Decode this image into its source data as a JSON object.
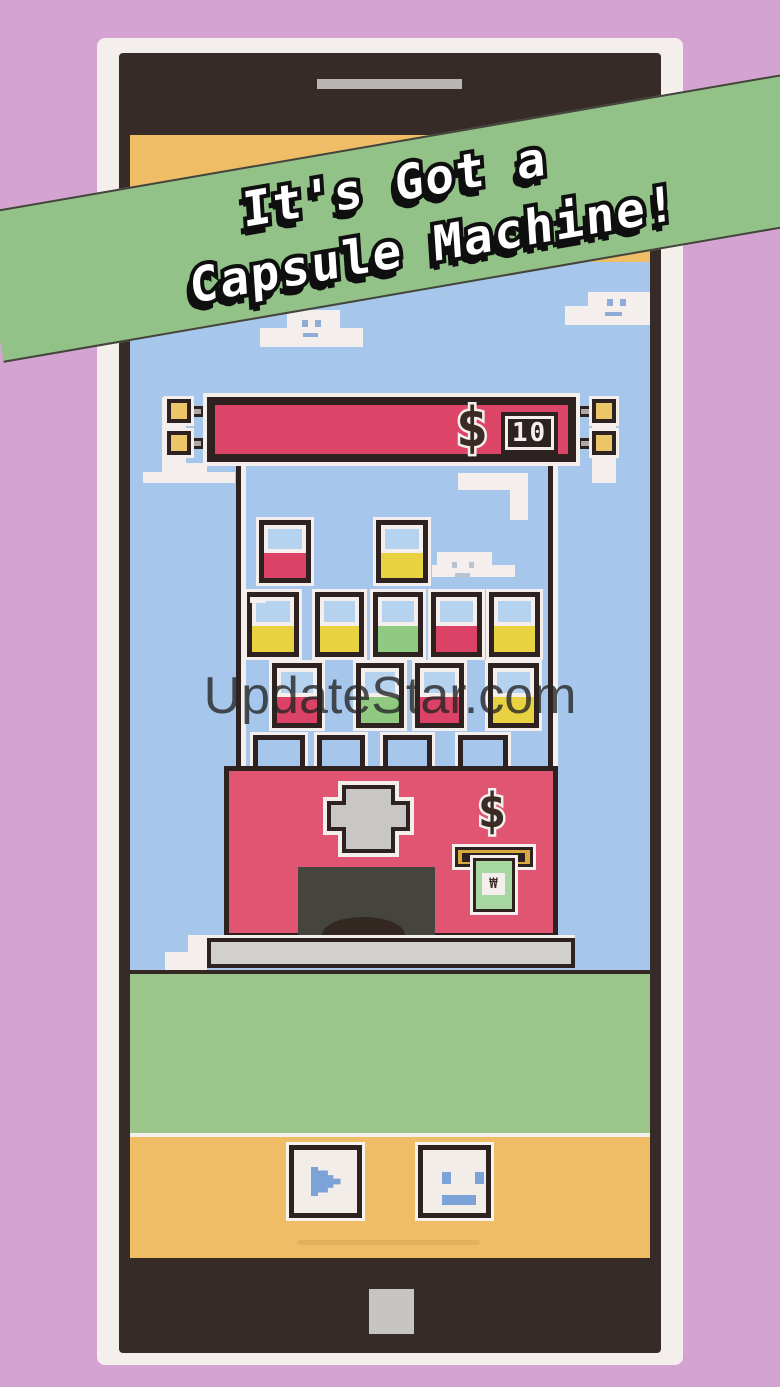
{
  "banner": {
    "line1": "It's Got a",
    "line2": "Capsule Machine!"
  },
  "watermark": {
    "text": "UpdateStar.com"
  },
  "price_sign": {
    "currency_symbol": "$",
    "value": "10"
  },
  "machine": {
    "currency_symbol": "$",
    "bill_symbol": "₩"
  },
  "capsules": {
    "rows": [
      {
        "name": "top",
        "colors": [
          "red",
          "yellow"
        ]
      },
      {
        "name": "middle",
        "colors": [
          "yellow",
          "yellow",
          "green",
          "red",
          "yellow"
        ]
      },
      {
        "name": "lower",
        "colors": [
          "red",
          "green",
          "red",
          "yellow"
        ]
      }
    ],
    "empty_slot_count": 4,
    "palette": {
      "red": "#dc4166",
      "yellow": "#e9d242",
      "green": "#8fca80"
    }
  },
  "controls": {
    "left_icon": "play-arrow-icon",
    "right_icon": "face-icon"
  },
  "colors": {
    "background": "#d5a3d2",
    "banner": "#92c287",
    "sky": "#a6c7eb",
    "ground": "#9cc58b",
    "screen_orange": "#eebd66",
    "sign_red": "#dc4568",
    "machine_pink": "#e05672",
    "outline_dark": "#2e2220",
    "outline_white": "#f4efec",
    "icon_blue": "#7ba3d8"
  }
}
